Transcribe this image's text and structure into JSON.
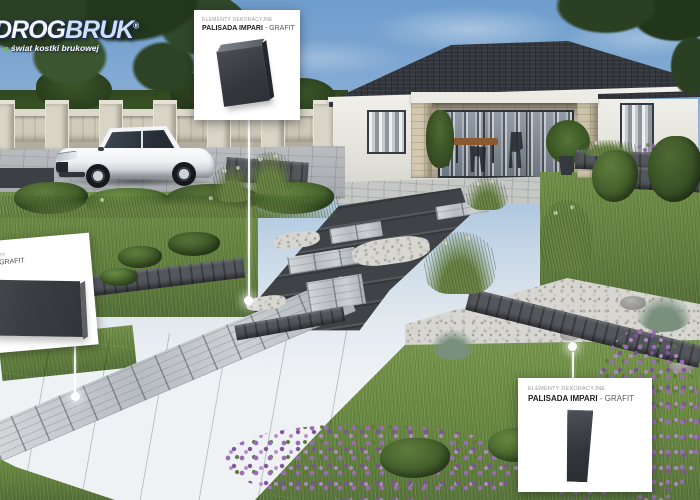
{
  "brand": {
    "logo_part1": "DROG",
    "logo_part2": "BRUK",
    "reg_mark": "®",
    "tagline": "świat kostki brukowej"
  },
  "callouts": {
    "top": {
      "category": "ELEMENTY DEKORACYJNE",
      "product": "PALISADA IMPARI",
      "separator": " - ",
      "variant": "GRAFIT"
    },
    "bottom_right": {
      "category": "ELEMENTY DEKORACYJNE",
      "product": "PALISADA IMPARI",
      "separator": " - ",
      "variant": "GRAFIT"
    },
    "left": {
      "category_fragment": "RY",
      "variant_fragment": "GRAFIT"
    }
  },
  "colors": {
    "product_graphite": "#3a3d41",
    "card_background": "#ffffff",
    "callout_line": "#f5f5f5"
  }
}
